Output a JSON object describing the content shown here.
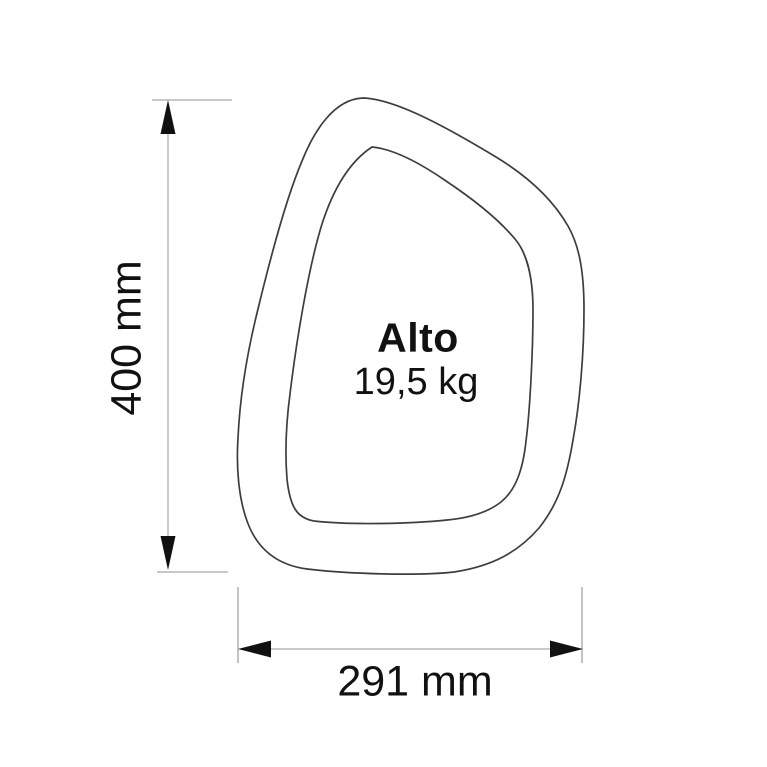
{
  "product": {
    "name": "Alto",
    "weight": "19,5 kg"
  },
  "dimensions": {
    "height_label": "400 mm",
    "width_label": "291 mm"
  },
  "icons": {
    "arrow-up-icon": "black solid triangle pointing up",
    "arrow-down-icon": "black solid triangle pointing down",
    "arrow-left-icon": "black solid triangle pointing left",
    "arrow-right-icon": "black solid triangle pointing right"
  },
  "colors": {
    "background": "#ffffff",
    "outline": "#3d3d3d",
    "dimension_line": "#c2c2c2",
    "extension_line": "#b5b5b5",
    "arrowhead": "#111111",
    "text": "#111111"
  }
}
